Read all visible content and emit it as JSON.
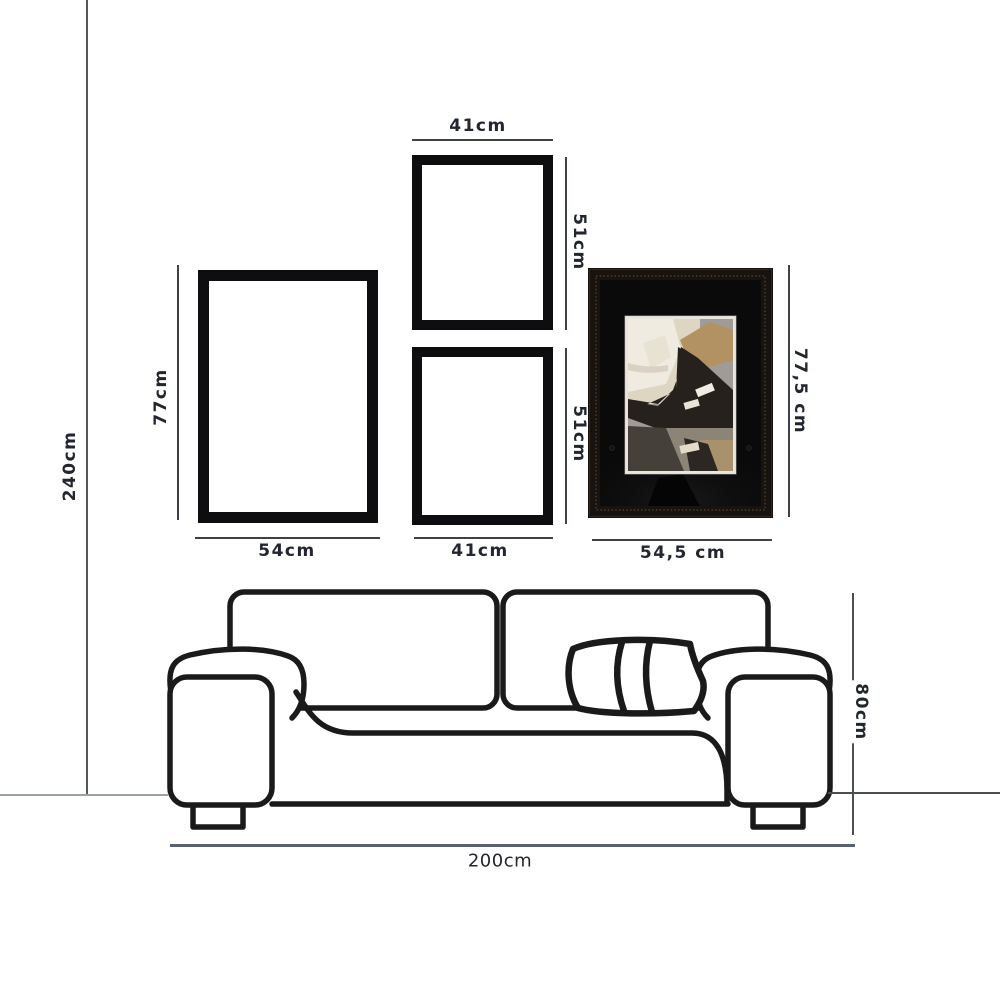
{
  "title": "Gallery wall and sofa dimension diagram",
  "wall": {
    "height_label": "240cm"
  },
  "gallery": {
    "frame_large": {
      "width_label": "54cm",
      "height_label": "77cm"
    },
    "frame_top": {
      "width_label": "41cm",
      "height_label": "51cm"
    },
    "frame_bottom": {
      "width_label": "41cm",
      "height_label": "51cm"
    },
    "frame_art": {
      "width_label": "54,5 cm",
      "height_label": "77,5 cm"
    }
  },
  "sofa": {
    "width_label": "200cm",
    "height_label": "80cm"
  },
  "colors": {
    "frame_border": "#0e0e10",
    "dimension_line": "#3c414d",
    "floor_line_left": "#9aa0aa",
    "sofa_width_line": "#5a6170",
    "sofa_outline": "#1a1a1a",
    "art_frame": "#1a1410",
    "art_mat": "#0a0a0b",
    "art_cream": "#e6ddc9",
    "art_gray": "#a09b96",
    "art_dark": "#26211c",
    "art_tan": "#b09268",
    "art_taupe": "#8d8478"
  }
}
